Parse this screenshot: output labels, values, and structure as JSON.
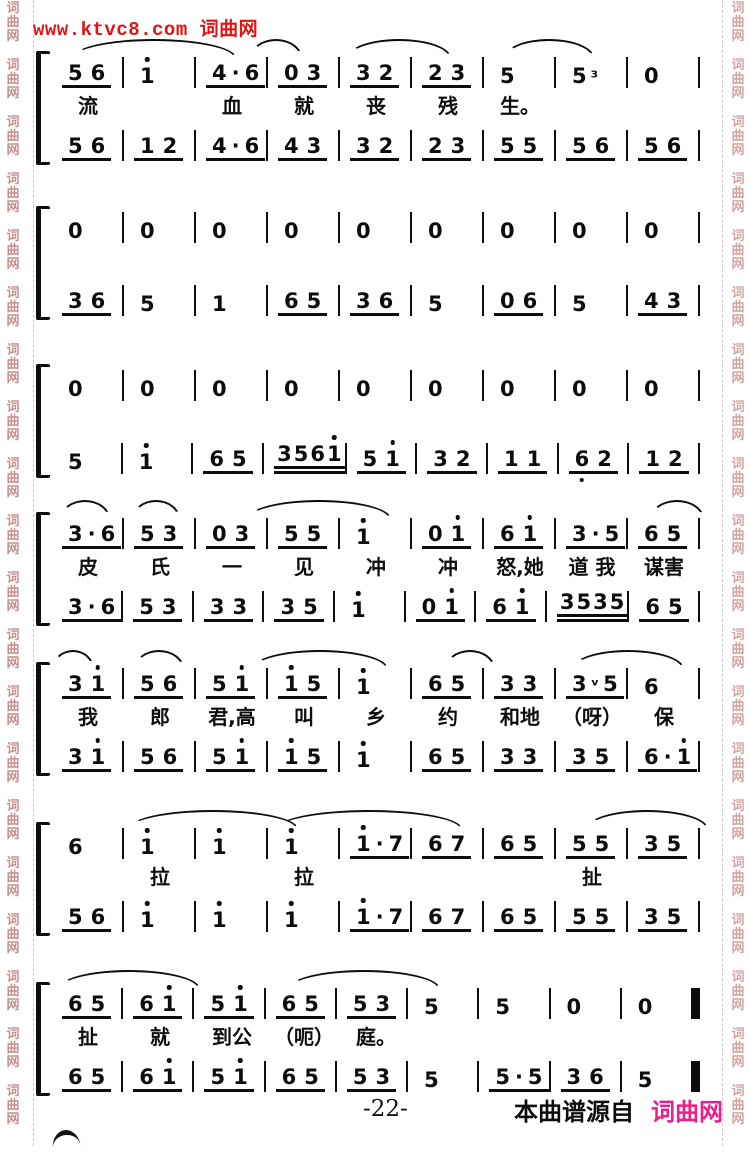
{
  "header": {
    "watermark_site": "www.ktvc8.com 词曲网"
  },
  "watermark": {
    "chars": [
      "词",
      "曲",
      "网"
    ],
    "repeat": 20
  },
  "footer": {
    "page_number": "-22-",
    "source_label": "本曲谱源自",
    "source_site": "词曲网"
  },
  "colors": {
    "header_red": "#e01414",
    "footer_pink": "#ea1f8e",
    "watermark_pink": "#c78f8f",
    "ink": "#0d0d0d"
  },
  "score": {
    "notation": "jianpu",
    "systems": [
      {
        "top": [
          "56_",
          "1'",
          "4·6_",
          "03_",
          "32_",
          "23_",
          "5",
          "5³",
          "0"
        ],
        "lyrics": [
          "流",
          "",
          "血",
          "就",
          "丧",
          "残",
          "生。",
          "",
          ""
        ],
        "bottom": [
          "56_",
          "12_",
          "4·6_",
          "43_",
          "32_",
          "23_",
          "55_",
          "56_",
          "56_"
        ]
      },
      {
        "top": [
          "0",
          "0",
          "0",
          "0",
          "0",
          "0",
          "0",
          "0",
          "0"
        ],
        "lyrics": [
          "",
          "",
          "",
          "",
          "",
          "",
          "",
          "",
          ""
        ],
        "bottom": [
          "36_",
          "5",
          "1",
          "65_",
          "36_",
          "5",
          "06_",
          "5",
          "43_"
        ]
      },
      {
        "top": [
          "0",
          "0",
          "0",
          "0",
          "0",
          "0",
          "0",
          "0",
          "0"
        ],
        "lyrics": [
          "",
          "",
          "",
          "",
          "",
          "",
          "",
          "",
          ""
        ],
        "bottom": [
          "5",
          "1'",
          "65_",
          "3561'=",
          "51'_",
          "32_",
          "11_",
          "6,2_",
          "12_"
        ]
      },
      {
        "top": [
          "3·6_",
          "53_",
          "03_",
          "55_",
          "1'",
          "01'_",
          "61'_",
          "3·5_",
          "65_"
        ],
        "lyrics": [
          "皮",
          "氏",
          "一",
          "见",
          "冲",
          "冲",
          "怒,她",
          "道 我",
          "谋害"
        ],
        "bottom": [
          "3·6_",
          "53_",
          "33_",
          "35_",
          "1'",
          "01'_",
          "61'_",
          "3535=",
          "65_"
        ]
      },
      {
        "top": [
          "31'_",
          "56_",
          "51'_",
          "1'5_",
          "1'",
          "65_",
          "33_",
          "3ᵛ5_",
          "6"
        ],
        "lyrics": [
          "我",
          "郎",
          "君,高",
          "叫",
          "乡",
          "约",
          "和地",
          "（呀）",
          "保"
        ],
        "bottom": [
          "31'_",
          "56_",
          "51'_",
          "1'5_",
          "1'",
          "65_",
          "33_",
          "35_",
          "6·1'_"
        ]
      },
      {
        "top": [
          "6",
          "1'",
          "1'",
          "1'",
          "1'·7_",
          "67_",
          "65_",
          "55_",
          "35_"
        ],
        "lyrics": [
          "",
          "拉",
          "",
          "拉",
          "",
          "",
          "",
          "扯",
          ""
        ],
        "bottom": [
          "56_",
          "1'",
          "1'",
          "1'",
          "1'·7_",
          "67_",
          "65_",
          "55_",
          "35_"
        ]
      },
      {
        "top": [
          "65_",
          "61'_",
          "51'_",
          "65_",
          "53_",
          "5",
          "5",
          "0",
          "0"
        ],
        "lyrics": [
          "扯",
          "就",
          "到公",
          "（呃）",
          "庭。",
          "",
          "",
          "",
          ""
        ],
        "bottom": [
          "65_",
          "61'_",
          "51'_",
          "65_",
          "53_",
          "5",
          "5·5_",
          "36_",
          "5"
        ]
      }
    ]
  }
}
